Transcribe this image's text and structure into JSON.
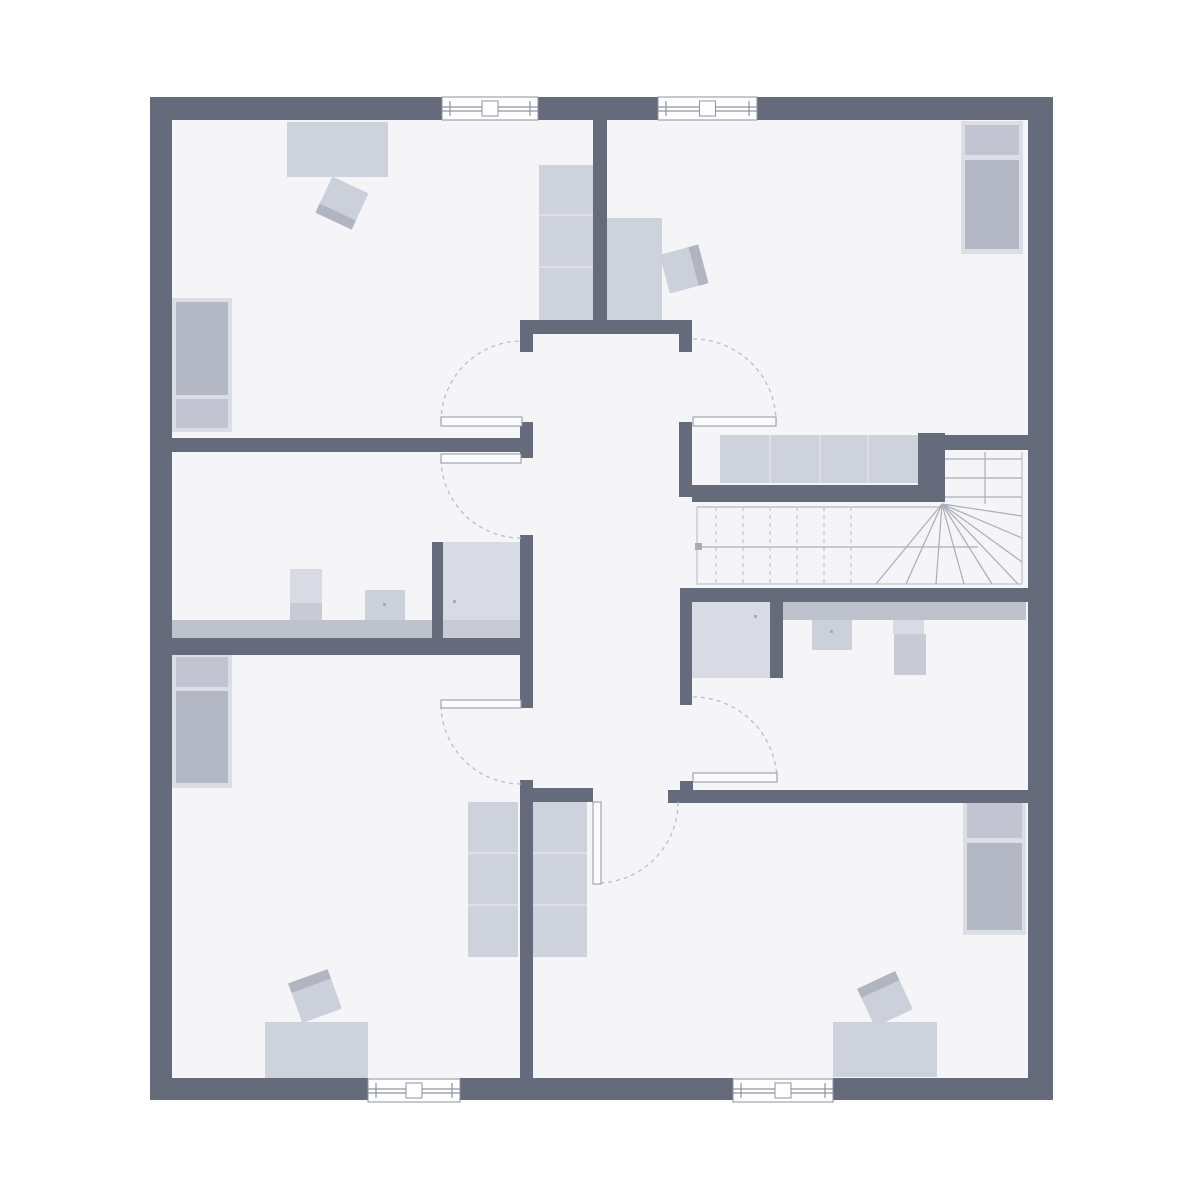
{
  "palette": {
    "bg": "#ffffff",
    "floor": "#f5f5f7",
    "wall": "#666b7c",
    "furniture_light": "#ced2dc",
    "furniture_mid": "#c4c8d3",
    "furniture_dark": "#b4b8c5",
    "bed_frame": "#dcdee6",
    "pillow": "#c2c5d1",
    "counter": "#bec2cd",
    "fixture_light": "#d9dbe4",
    "fixture_mid": "#c8cbd6",
    "chair_body": "#ccd0da",
    "chair_back": "#b1b5c2",
    "wardrobe_divider": "#e6e8ee",
    "door_leaf_fill": "#fbfbfd",
    "door_leaf_border": "#9094a2",
    "door_arc": "#b9bdc8",
    "stair_line": "#a9adba",
    "stair_dash": "#c2c5d0",
    "stair_outline": "#b3b7c3",
    "window_border": "#8d91a0",
    "dot": "#a7abb8"
  },
  "plan": {
    "bounds": [
      150,
      97,
      903,
      1003
    ],
    "walls": [
      [
        150,
        97,
        292,
        23
      ],
      [
        538,
        97,
        120,
        23
      ],
      [
        757,
        97,
        296,
        23
      ],
      [
        150,
        1078,
        218,
        22
      ],
      [
        460,
        1078,
        273,
        22
      ],
      [
        833,
        1078,
        220,
        22
      ],
      [
        150,
        97,
        22,
        1003
      ],
      [
        1028,
        97,
        25,
        1003
      ],
      [
        593,
        120,
        14,
        200
      ],
      [
        520,
        320,
        172,
        14
      ],
      [
        520,
        334,
        13,
        18
      ],
      [
        679,
        334,
        13,
        18
      ],
      [
        170,
        438,
        363,
        14
      ],
      [
        520,
        422,
        13,
        36
      ],
      [
        520,
        535,
        13,
        173
      ],
      [
        170,
        638,
        363,
        17
      ],
      [
        432,
        542,
        11,
        98
      ],
      [
        520,
        780,
        13,
        298
      ],
      [
        533,
        788,
        60,
        14
      ],
      [
        668,
        790,
        360,
        13
      ],
      [
        680,
        781,
        13,
        11
      ],
      [
        680,
        588,
        348,
        14
      ],
      [
        680,
        602,
        12,
        103
      ],
      [
        770,
        602,
        13,
        76
      ],
      [
        679,
        422,
        13,
        75
      ],
      [
        692,
        485,
        253,
        17
      ],
      [
        918,
        433,
        27,
        69
      ],
      [
        925,
        435,
        103,
        15
      ]
    ],
    "windows": [
      [
        442,
        97,
        96,
        23
      ],
      [
        658,
        97,
        99,
        23
      ],
      [
        368,
        1079,
        92,
        23
      ],
      [
        733,
        1079,
        100,
        23
      ]
    ],
    "doors": [
      {
        "leaf": [
          441,
          417,
          81,
          9
        ],
        "arc": {
          "c": [
            522,
            422
          ],
          "r": 81,
          "a0": 180,
          "a1": 270
        }
      },
      {
        "leaf": [
          441,
          454,
          80,
          9
        ],
        "arc": {
          "c": [
            521,
            458
          ],
          "r": 80,
          "a0": 90,
          "a1": 180
        }
      },
      {
        "leaf": [
          693,
          417,
          83,
          9
        ],
        "arc": {
          "c": [
            693,
            422
          ],
          "r": 83,
          "a0": 270,
          "a1": 360
        }
      },
      {
        "leaf": [
          693,
          773,
          84,
          9
        ],
        "arc": {
          "c": [
            693,
            781
          ],
          "r": 84,
          "a0": 270,
          "a1": 360
        }
      },
      {
        "leaf": [
          441,
          700,
          80,
          8
        ],
        "arc": {
          "c": [
            521,
            704
          ],
          "r": 80,
          "a0": 90,
          "a1": 180
        }
      },
      {
        "leaf": [
          593,
          802,
          8,
          82
        ],
        "arc": {
          "c": [
            597,
            802
          ],
          "r": 81,
          "a0": 0,
          "a1": 90
        }
      }
    ],
    "beds": [
      {
        "frame": [
          172,
          298,
          60,
          134
        ],
        "pillow": [
          176,
          399,
          52,
          29
        ],
        "mattress": [
          176,
          302,
          52,
          93
        ]
      },
      {
        "frame": [
          961,
          121,
          62,
          133
        ],
        "pillow": [
          965,
          125,
          54,
          30
        ],
        "mattress": [
          965,
          160,
          54,
          89
        ]
      },
      {
        "frame": [
          172,
          653,
          60,
          135
        ],
        "pillow": [
          176,
          657,
          52,
          30
        ],
        "mattress": [
          176,
          691,
          52,
          92
        ]
      },
      {
        "frame": [
          963,
          798,
          63,
          137
        ],
        "pillow": [
          967,
          802,
          55,
          36
        ],
        "mattress": [
          967,
          843,
          55,
          87
        ]
      }
    ],
    "wardrobes": [
      {
        "rect": [
          539,
          165,
          54,
          155
        ],
        "dir": "h",
        "lines": [
          215,
          267
        ]
      },
      {
        "rect": [
          468,
          802,
          50,
          155
        ],
        "dir": "h",
        "lines": [
          853,
          905
        ]
      },
      {
        "rect": [
          533,
          802,
          54,
          155
        ],
        "dir": "h",
        "lines": [
          853,
          905
        ]
      },
      {
        "rect": [
          720,
          435,
          198,
          48
        ],
        "dir": "v",
        "lines": [
          770,
          820,
          868
        ]
      }
    ],
    "desks": [
      [
        287,
        122,
        101,
        55
      ],
      [
        607,
        218,
        55,
        102
      ],
      [
        265,
        1022,
        103,
        56
      ],
      [
        833,
        1022,
        104,
        55
      ]
    ],
    "chairs": [
      {
        "x": 322,
        "y": 183,
        "s": 40,
        "rot": 25,
        "back": "bottom"
      },
      {
        "x": 664,
        "y": 249,
        "s": 40,
        "rot": -15,
        "back": "right"
      },
      {
        "x": 294,
        "y": 975,
        "s": 42,
        "rot": -20,
        "back": "top"
      },
      {
        "x": 864,
        "y": 978,
        "s": 42,
        "rot": -25,
        "back": "top"
      }
    ],
    "bathrooms": {
      "counters": [
        [
          170,
          620,
          262,
          18
        ],
        [
          783,
          602,
          243,
          18
        ]
      ],
      "showers": [
        {
          "body": [
            443,
            542,
            77,
            96
          ],
          "band": [
            443,
            620,
            77,
            18
          ]
        },
        {
          "body": [
            692,
            602,
            78,
            76
          ],
          "band": null
        }
      ],
      "sinks": [
        [
          365,
          590,
          40,
          30
        ],
        [
          812,
          620,
          40,
          30
        ]
      ],
      "toilets": [
        {
          "tank": [
            290,
            569,
            32,
            34
          ],
          "bowl": [
            290,
            603,
            32,
            17
          ]
        },
        {
          "tank": [
            893,
            620,
            31,
            14
          ],
          "bowl": [
            894,
            634,
            32,
            41
          ]
        }
      ],
      "dots": [
        [
          383,
          603
        ],
        [
          453,
          600
        ],
        [
          754,
          615
        ],
        [
          830,
          630
        ]
      ]
    },
    "stairs": {
      "outline": [
        [
          697,
          507
        ],
        [
          697,
          584
        ],
        [
          1022,
          584
        ],
        [
          1022,
          452
        ]
      ],
      "top_edge": [
        [
          697,
          507
        ],
        [
          942,
          507
        ]
      ],
      "dashed_treads": {
        "xs": [
          716,
          743,
          770,
          797,
          824,
          851
        ],
        "y1": 507,
        "y2": 584
      },
      "fan": {
        "pivot": [
          942,
          504
        ],
        "ends": [
          [
            876,
            584
          ],
          [
            906,
            584
          ],
          [
            936,
            584
          ],
          [
            964,
            584
          ],
          [
            992,
            584
          ],
          [
            1018,
            584
          ],
          [
            1022,
            562
          ],
          [
            1022,
            538
          ],
          [
            1022,
            516
          ]
        ]
      },
      "upper_treads": {
        "ys": [
          459,
          478,
          497
        ],
        "x1": 945,
        "x2": 1022
      },
      "divider": [
        [
          985,
          452
        ],
        [
          985,
          504
        ]
      ],
      "walk_line": [
        [
          700,
          547
        ],
        [
          978,
          547
        ]
      ],
      "walk_dot": [
        695,
        543,
        7,
        7
      ]
    }
  }
}
